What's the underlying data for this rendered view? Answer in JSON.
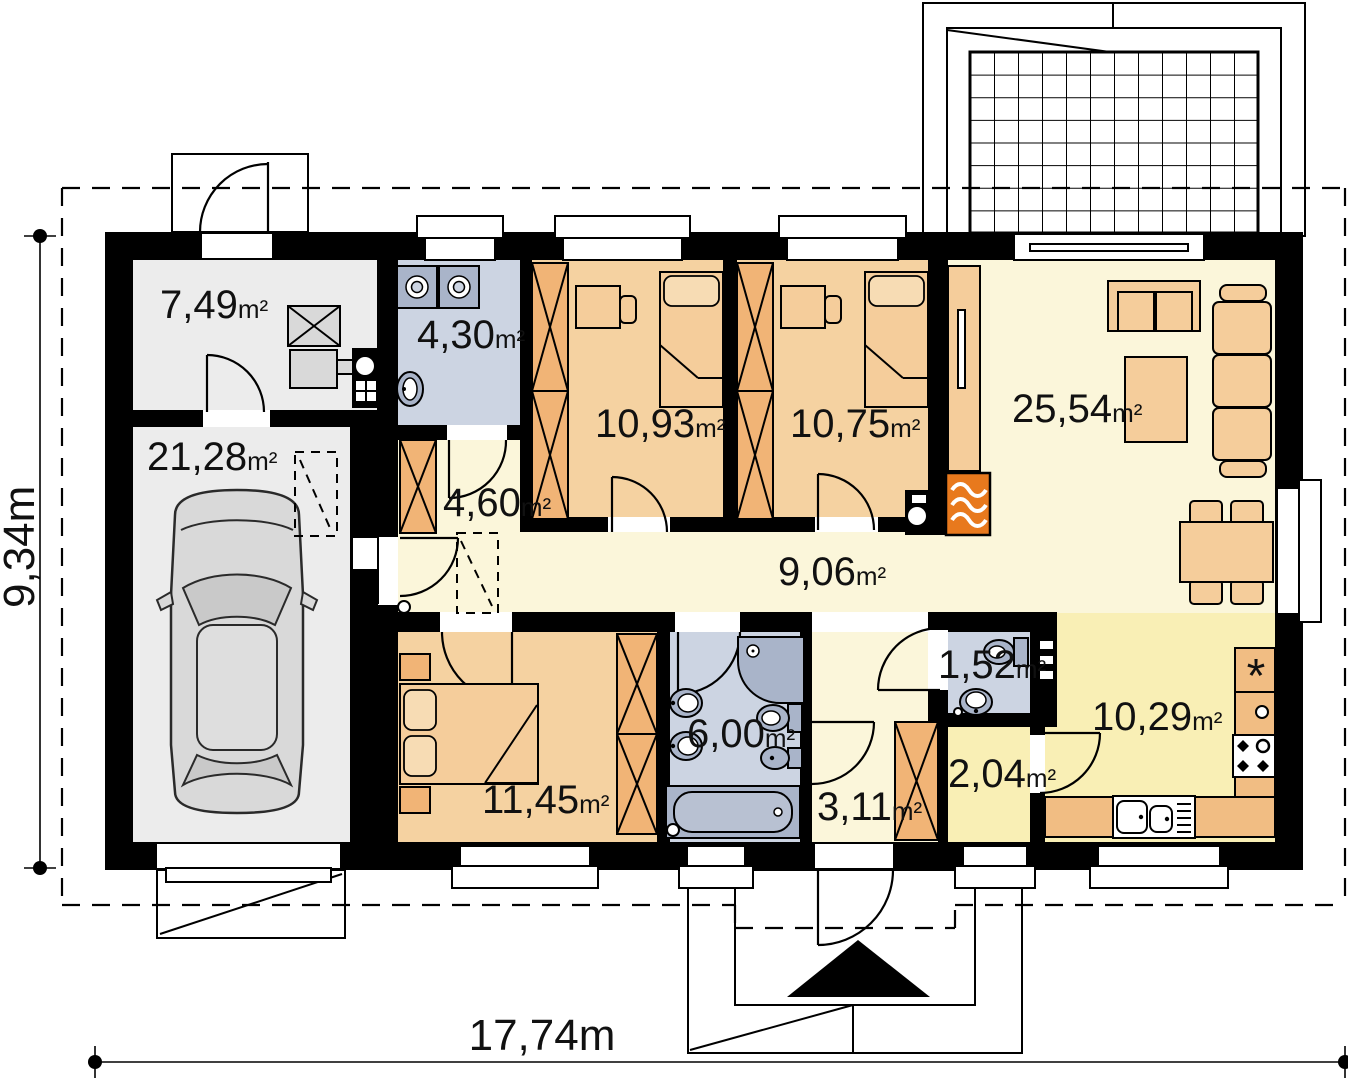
{
  "plan": {
    "type": "single-storey house floor plan",
    "total_width_label": "17,74m",
    "total_height_label": "9,34m",
    "area_unit": "m²"
  },
  "rooms": [
    {
      "name": "utility-room",
      "area": "7,49"
    },
    {
      "name": "laundry",
      "area": "4,30"
    },
    {
      "name": "garage",
      "area": "21,28"
    },
    {
      "name": "bedroom-1",
      "area": "10,93"
    },
    {
      "name": "bedroom-2",
      "area": "10,75"
    },
    {
      "name": "living-room",
      "area": "25,54"
    },
    {
      "name": "entry-hall",
      "area": "4,60"
    },
    {
      "name": "corridor",
      "area": "9,06"
    },
    {
      "name": "wc",
      "area": "1,52"
    },
    {
      "name": "bedroom-3",
      "area": "11,45"
    },
    {
      "name": "bathroom",
      "area": "6,00"
    },
    {
      "name": "hall",
      "area": "3,11"
    },
    {
      "name": "pantry",
      "area": "2,04"
    },
    {
      "name": "kitchen",
      "area": "10,29"
    }
  ],
  "symbols": {
    "fridge": "*"
  },
  "colors": {
    "wall": "#000000",
    "floor_grey": "#ececec",
    "floor_blue": "#ccd4e2",
    "floor_tan": "#f5d2a1",
    "floor_cream": "#fbf6da",
    "floor_yellow": "#f9efb5",
    "furniture_tan": "#f5cd9b",
    "wardrobe_orange": "#f1b476",
    "counter_orange": "#f1bd83",
    "fixture_blue": "#a9b4c9",
    "fireplace_orange": "#e8791d"
  }
}
